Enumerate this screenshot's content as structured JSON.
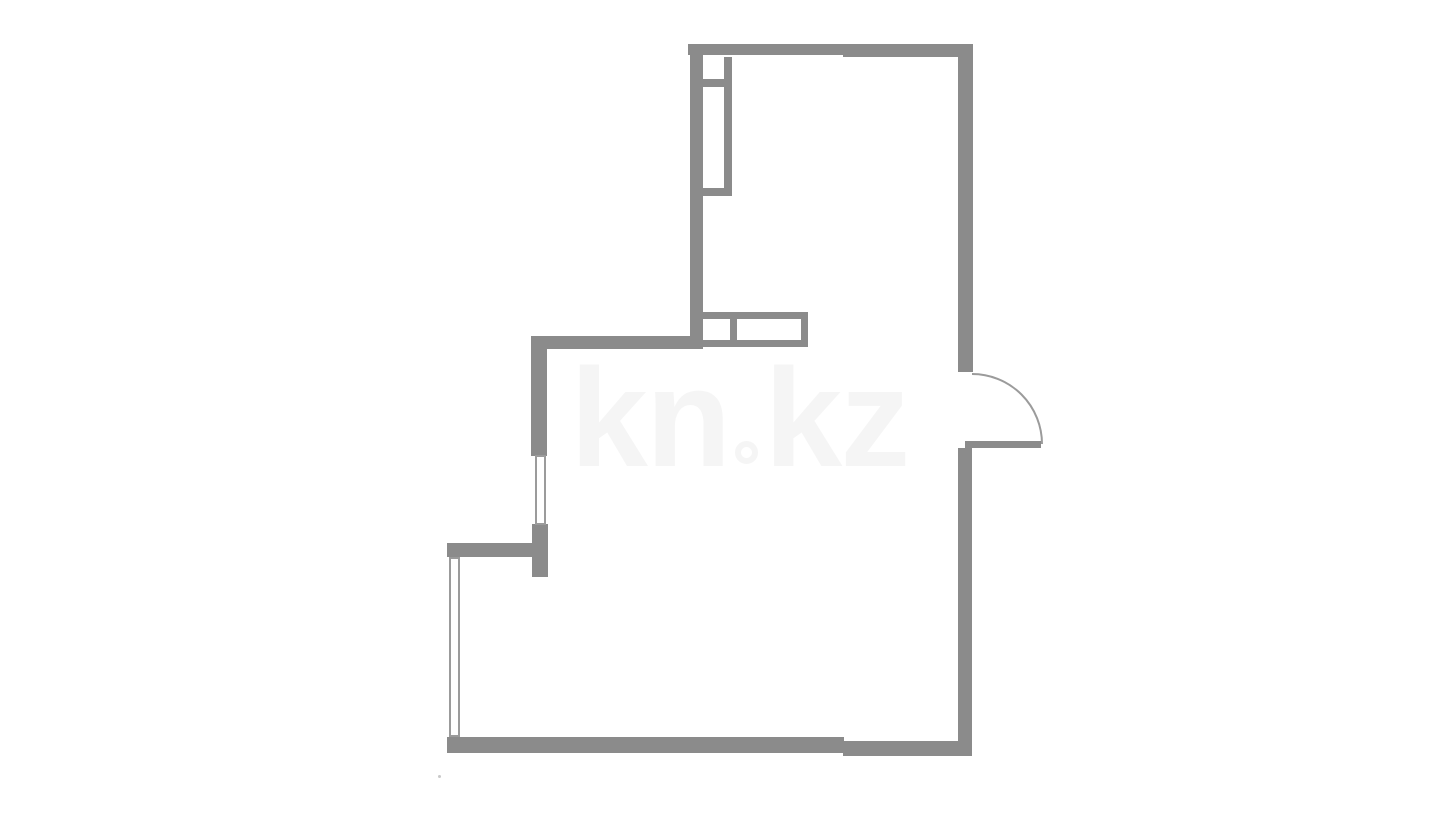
{
  "watermark": {
    "full_text": "kn.kz",
    "left_part": "kn",
    "right_part": "kz",
    "color": "#f5f5f5",
    "font_size_px": 140,
    "x": 570,
    "y": 348,
    "dot_diameter_px": 23,
    "dot_border_px": 6
  },
  "colors": {
    "background": "#ffffff",
    "wall": "#8b8b8b",
    "thin_line": "#9b9b9b",
    "corner_dot": "#c9c9c9"
  },
  "floorplan": {
    "walls": [
      {
        "name": "top-wall-left-segment",
        "x": 688,
        "y": 44,
        "w": 157,
        "h": 11
      },
      {
        "name": "top-wall-right-segment",
        "x": 843,
        "y": 44,
        "w": 130,
        "h": 13
      },
      {
        "name": "left-wall-upper",
        "x": 690,
        "y": 44,
        "w": 13,
        "h": 305
      },
      {
        "name": "right-wall-upper",
        "x": 958,
        "y": 44,
        "w": 15,
        "h": 328
      },
      {
        "name": "shaft-right-edge",
        "x": 724,
        "y": 57,
        "w": 8,
        "h": 139
      },
      {
        "name": "shaft-divider",
        "x": 703,
        "y": 79,
        "w": 21,
        "h": 8
      },
      {
        "name": "shaft-bottom-edge",
        "x": 703,
        "y": 188,
        "w": 21,
        "h": 8
      },
      {
        "name": "cabinet-top-edge",
        "x": 700,
        "y": 312,
        "w": 108,
        "h": 7
      },
      {
        "name": "cabinet-divider",
        "x": 730,
        "y": 312,
        "w": 7,
        "h": 33
      },
      {
        "name": "cabinet-right-edge",
        "x": 801,
        "y": 312,
        "w": 7,
        "h": 33
      },
      {
        "name": "cabinet-bottom-edge",
        "x": 703,
        "y": 340,
        "w": 105,
        "h": 7
      },
      {
        "name": "mid-horizontal-wall",
        "x": 531,
        "y": 336,
        "w": 172,
        "h": 13
      },
      {
        "name": "left-wall-above-upper-window",
        "x": 531,
        "y": 336,
        "w": 16,
        "h": 120
      },
      {
        "name": "left-wall-below-upper-window",
        "x": 532,
        "y": 524,
        "w": 16,
        "h": 53
      },
      {
        "name": "lower-left-horizontal-wall",
        "x": 447,
        "y": 543,
        "w": 86,
        "h": 14
      },
      {
        "name": "bottom-wall-left-segment",
        "x": 447,
        "y": 737,
        "w": 397,
        "h": 16
      },
      {
        "name": "bottom-wall-right-segment",
        "x": 843,
        "y": 741,
        "w": 129,
        "h": 15
      },
      {
        "name": "right-wall-lower",
        "x": 958,
        "y": 448,
        "w": 14,
        "h": 308
      },
      {
        "name": "door-leaf",
        "x": 965,
        "y": 441,
        "w": 76,
        "h": 7
      }
    ],
    "windows": [
      {
        "name": "upper-window",
        "x": 535,
        "y": 455,
        "w": 11,
        "h": 70,
        "line_px": 2
      },
      {
        "name": "lower-window",
        "x": 449,
        "y": 557,
        "w": 11,
        "h": 180,
        "line_px": 2
      }
    ],
    "door": {
      "name": "entry-door-swing",
      "arc_start_x": 972,
      "arc_start_y": 374,
      "arc_end_x": 1042,
      "arc_end_y": 444,
      "radius": 70,
      "stroke_px": 2
    },
    "corner_dot": {
      "x": 438,
      "y": 775,
      "size": 3
    }
  }
}
